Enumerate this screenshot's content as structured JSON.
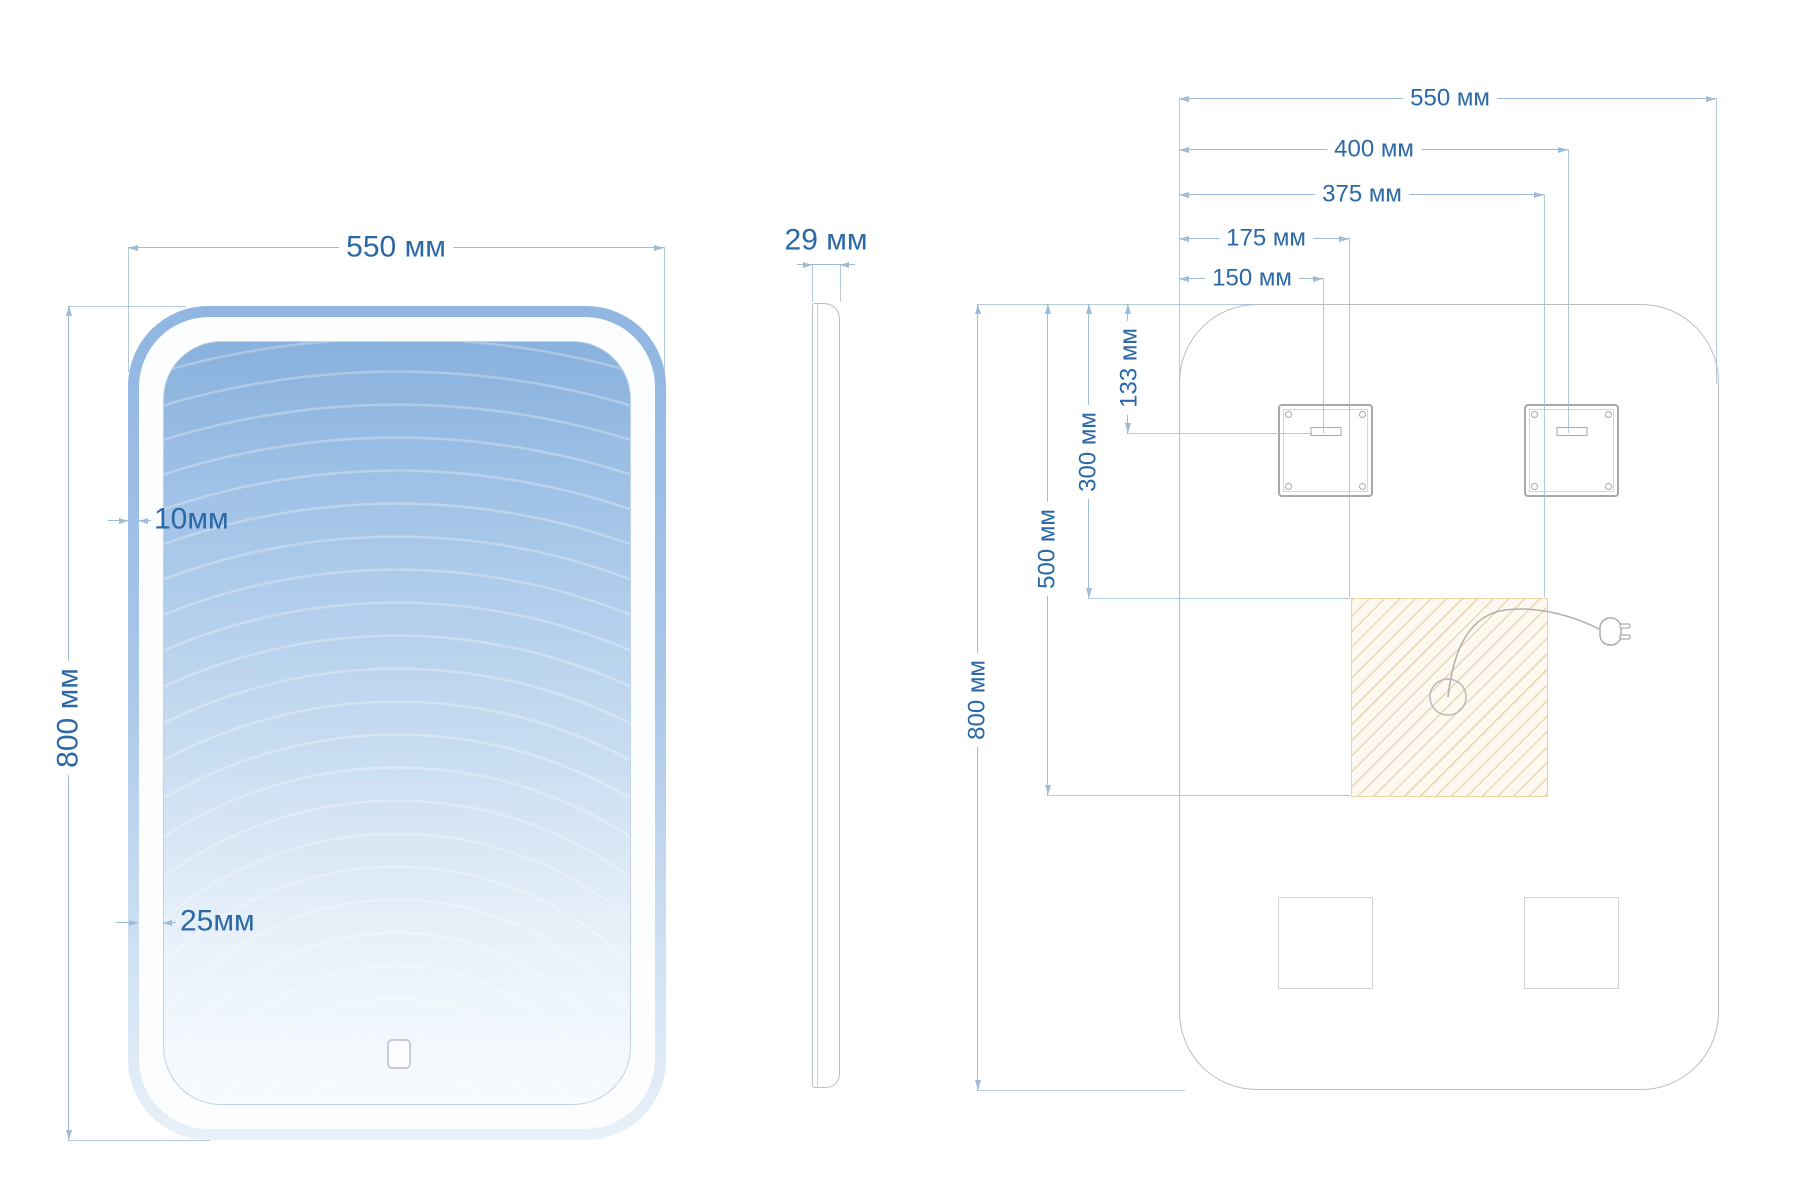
{
  "front_view": {
    "width_label": "550 мм",
    "height_label": "800 мм",
    "frame_width_label": "10мм",
    "led_width_label": "25мм"
  },
  "side_view": {
    "depth_label": "29 мм"
  },
  "back_view": {
    "width_label": "550 мм",
    "right_bracket_center_label": "400 мм",
    "hatch_right_label": "375 мм",
    "hatch_left_label": "175 мм",
    "left_bracket_center_label": "150 мм",
    "height_label": "800 мм",
    "hatch_bottom_label": "500 мм",
    "hatch_top_label": "300 мм",
    "bracket_slot_drop_label": "133 мм"
  },
  "colors": {
    "dimension_text": "#2b68a6",
    "dimension_line": "#9fbcd6",
    "frame_blue_top": "#8fb6e1",
    "mirror_blue_top": "#89b1dd",
    "mirror_white_bottom": "#f7fbfe",
    "outline_gray": "#bcbcbc",
    "hatch_line": "#e2b97d",
    "hatch_bg": "#fdf9f0"
  }
}
